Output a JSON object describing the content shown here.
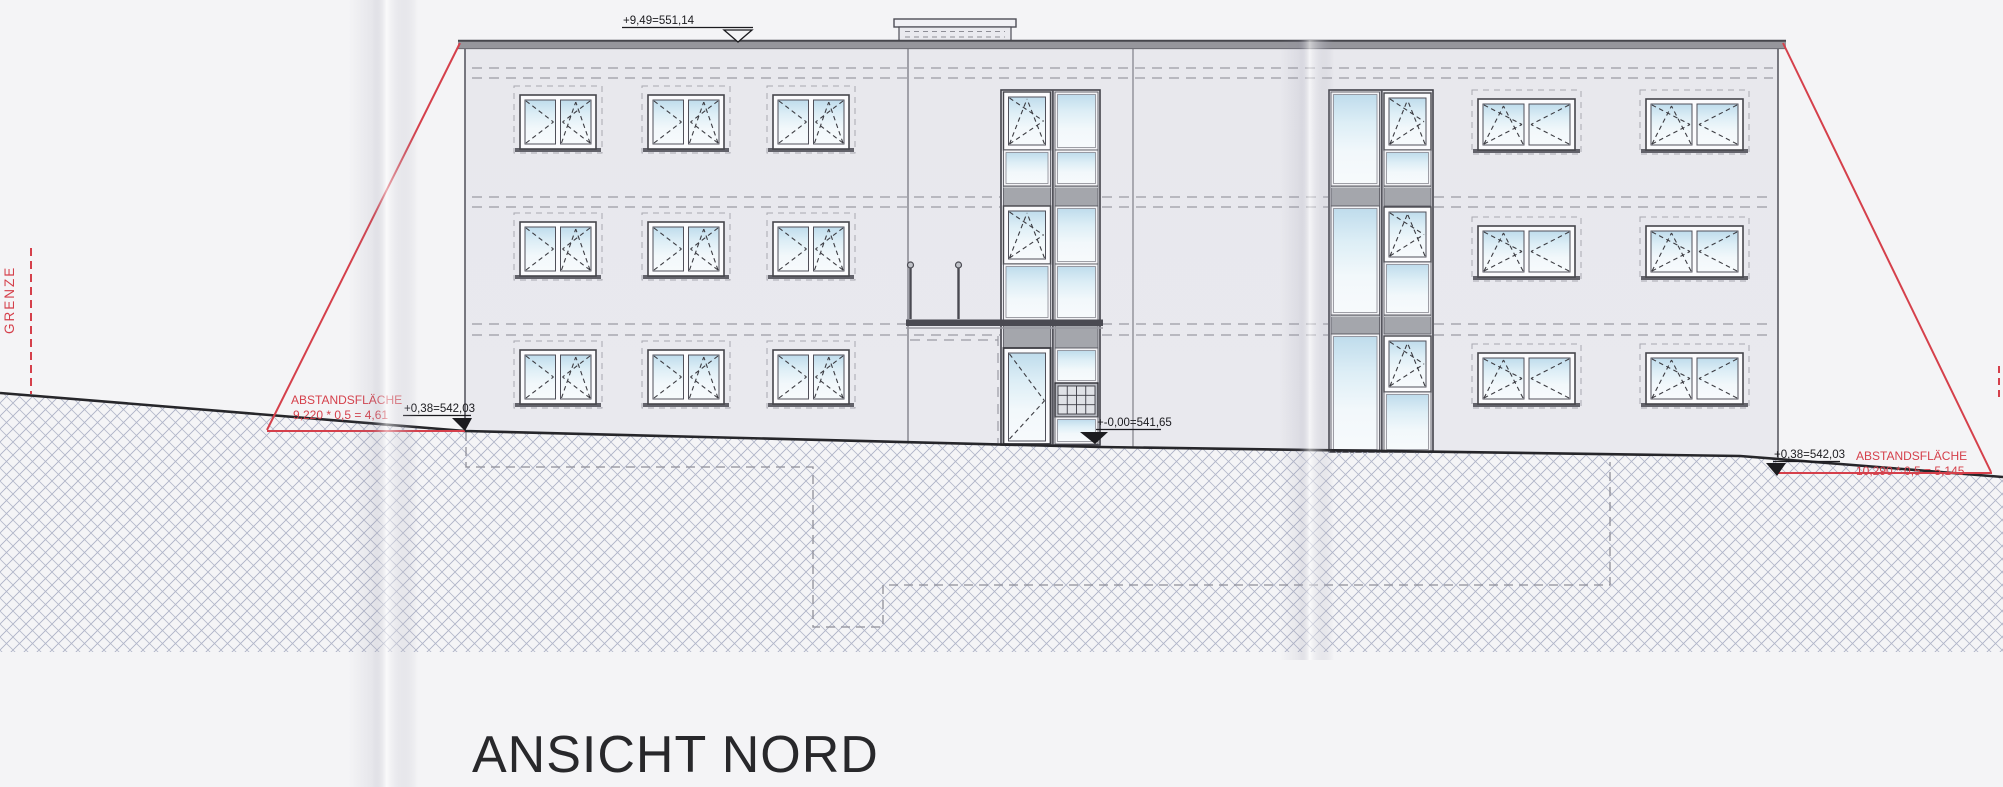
{
  "drawing_title": "ANSICHT NORD",
  "annotations": {
    "boundary_label": "GRENZE",
    "roof_level": "+9,49=551,14",
    "left_ground_level": "+0,38=542,03",
    "entrance_level": "+-0,00=541,65",
    "right_ground_level": "+0,38=542,03",
    "setback_left_label": "ABSTANDSFLÄCHE",
    "setback_left_formula": "9,220 * 0,5 = 4,61",
    "setback_right_label": "ABSTANDSFLÄCHE",
    "setback_right_formula": "10,290 * 0,5 = 5,145"
  },
  "colors": {
    "annotation_red": "#d5404b",
    "facade": "#e9e9ee",
    "roof_band": "#96969c",
    "spandrel": "#a4a6ac",
    "glass_tint": "#c4dfee",
    "hatch_line": "#aab0c4",
    "terrain_line": "#26262a"
  }
}
